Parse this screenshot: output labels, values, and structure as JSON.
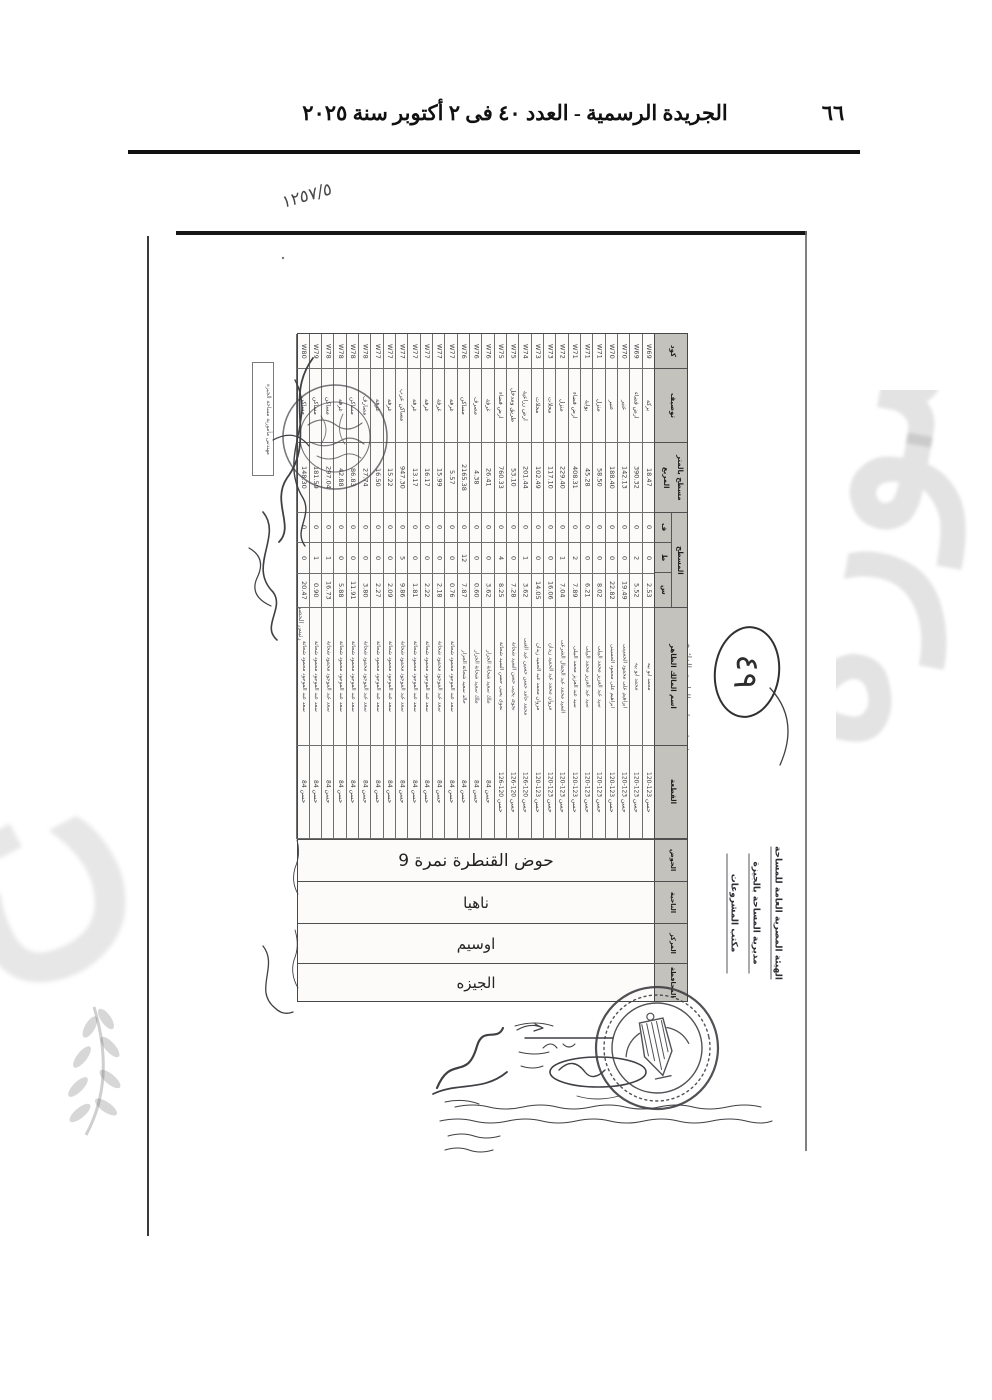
{
  "gazette": {
    "header_title": "الجريدة الرسمية - العدد ٤٠ فى ٢ أكتوبر سنة ٢٠٢٥",
    "page_number": "٦٦"
  },
  "annotations": {
    "file_mark": "١٢٥٧/٥",
    "circled_number": "٤٩",
    "side_title": "حصر ملاك ظاهرين لمشروع انشاء وتطوير الطريق الدائرى"
  },
  "agency": {
    "lines": [
      "الهيئة المصرية العامة للمساحة",
      "مديرية المساحة بالجيزة",
      "مكتب المشروعات"
    ]
  },
  "stamps": {
    "box_label": "مهندس مأمورية مساحة الجيزة",
    "review_label": "رئيس الحصر"
  },
  "watermark": {
    "fragment": "صورة"
  },
  "table": {
    "headers": {
      "code": "كود",
      "desc": "توصيف",
      "area": "مسطح بالمتر المربع",
      "surface": "المسطح",
      "surface_subs": [
        "ف",
        "ط",
        "س"
      ],
      "owner": "اسم المالك الظاهر",
      "parcel": "القطعة",
      "basin": "الحوض",
      "village": "الناحية",
      "district": "المركز",
      "governorate": "المحافظة"
    },
    "basin_value": "حوض القنطرة نمرة 9",
    "village_value": "ناهيا",
    "district_value": "اوسيم",
    "governorate_value": "الجيزه",
    "rows": [
      {
        "code": "W69",
        "desc": "بركة",
        "area": "18.47",
        "f": "0",
        "t": "0",
        "s": "2.53",
        "owner": "محمد ابو بيه",
        "parcel": "حسن 123-120"
      },
      {
        "code": "W69",
        "desc": "ارض فضاء",
        "area": "390.32",
        "f": "0",
        "t": "2",
        "s": "5.52",
        "owner": "محمد ابو بيه",
        "parcel": "حسن 123-120"
      },
      {
        "code": "W70",
        "desc": "عنبر",
        "area": "142.13",
        "f": "0",
        "t": "0",
        "s": "19.49",
        "owner": "ابراهيم على محمود الحسينى",
        "parcel": "حسن 123-120"
      },
      {
        "code": "W70",
        "desc": "عنبر",
        "area": "188.40",
        "f": "0",
        "t": "0",
        "s": "22.82",
        "owner": "ابراهيم على محمود الحسينى",
        "parcel": "حسن 123-120"
      },
      {
        "code": "W71",
        "desc": "منزل",
        "area": "58.50",
        "f": "0",
        "t": "0",
        "s": "8.02",
        "owner": "سيد عبد العزيز محمد البيلى",
        "parcel": "حسن 123-120"
      },
      {
        "code": "W71",
        "desc": "بوابة",
        "area": "45.28",
        "f": "0",
        "t": "0",
        "s": "6.21",
        "owner": "سيد عبد العزيز محمد البيلى",
        "parcel": "حسن 123-120"
      },
      {
        "code": "W71",
        "desc": "ارض فضاء",
        "area": "408.31",
        "f": "0",
        "t": "2",
        "s": "7.89",
        "owner": "سيد عبد العزيز محمد البيلى",
        "parcel": "حسن 123-120"
      },
      {
        "code": "W72",
        "desc": "منزل",
        "area": "229.40",
        "f": "0",
        "t": "1",
        "s": "7.04",
        "owner": "السيد محمد عبد الجمال الشرعى",
        "parcel": "حسن 123-120"
      },
      {
        "code": "W73",
        "desc": "محلات",
        "area": "117.10",
        "f": "0",
        "t": "0",
        "s": "16.06",
        "owner": "مروان محمد عبد الحميد زيدان",
        "parcel": "حسن 123-120"
      },
      {
        "code": "W73",
        "desc": "محلات",
        "area": "102.49",
        "f": "0",
        "t": "0",
        "s": "14.05",
        "owner": "مروان محمد عبد الحميد زيدان",
        "parcel": "حسن 123-120"
      },
      {
        "code": "W74",
        "desc": "ارض زراعية",
        "area": "201.44",
        "f": "0",
        "t": "1",
        "s": "3.62",
        "owner": "محمد حامد حسن حسين عبد الغنى",
        "parcel": "حسن 120-126"
      },
      {
        "code": "W75",
        "desc": "طريق ومدخل",
        "area": "53.10",
        "f": "0",
        "t": "0",
        "s": "7.28",
        "owner": "نجوى يحيى حسن السيد شحاتة",
        "parcel": "حسن 120-126"
      },
      {
        "code": "W75",
        "desc": "ارض فضاء",
        "area": "760.33",
        "f": "0",
        "t": "4",
        "s": "8.25",
        "owner": "نجوى يحيى حسن السيد شحاتة",
        "parcel": "حسن 120-126"
      },
      {
        "code": "W76",
        "desc": "غرفة",
        "area": "26.41",
        "f": "0",
        "t": "0",
        "s": "3.62",
        "owner": "ملك سعيد شحاتة الجزار",
        "parcel": "حسن 84"
      },
      {
        "code": "W76",
        "desc": "مصرف",
        "area": "4.38",
        "f": "0",
        "t": "0",
        "s": "0.60",
        "owner": "ملك سعيد شحاتة الجزار",
        "parcel": "حسن 84"
      },
      {
        "code": "W76",
        "desc": "مساكن",
        "area": "2165.38",
        "f": "0",
        "t": "12",
        "s": "7.87",
        "owner": "خالد سعيد شحاتة الجزار",
        "parcel": "حسن 84"
      },
      {
        "code": "W77",
        "desc": "غرفة",
        "area": "5.57",
        "f": "0",
        "t": "0",
        "s": "0.76",
        "owner": "سعد عبد الموجود محمود شحاتة",
        "parcel": "حسن 84"
      },
      {
        "code": "W77",
        "desc": "غرفة",
        "area": "15.99",
        "f": "0",
        "t": "0",
        "s": "2.18",
        "owner": "سعد عبد الموجود محمود شحاتة",
        "parcel": "حسن 84"
      },
      {
        "code": "W77",
        "desc": "غرفة",
        "area": "16.17",
        "f": "0",
        "t": "0",
        "s": "2.22",
        "owner": "سعد عبد الموجود محمود شحاتة",
        "parcel": "حسن 84"
      },
      {
        "code": "W77",
        "desc": "غرفة",
        "area": "13.17",
        "f": "0",
        "t": "0",
        "s": "1.81",
        "owner": "سعد عبد الموجود محمود شحاتة",
        "parcel": "حسن 84"
      },
      {
        "code": "W77",
        "desc": "مساكن عرب",
        "area": "947.30",
        "f": "0",
        "t": "5",
        "s": "9.86",
        "owner": "سعد عبد الموجود محمود شحاتة",
        "parcel": "حسن 84"
      },
      {
        "code": "W77",
        "desc": "غرفة",
        "area": "15.22",
        "f": "0",
        "t": "0",
        "s": "2.09",
        "owner": "سعد عبد الموجود محمود شحاتة",
        "parcel": "حسن 84"
      },
      {
        "code": "W77",
        "desc": "غرفة",
        "area": "16.50",
        "f": "0",
        "t": "0",
        "s": "2.27",
        "owner": "سعد عبد الموجود محمود شحاتة",
        "parcel": "حسن 84"
      },
      {
        "code": "W78",
        "desc": "مصارف",
        "area": "27.74",
        "f": "0",
        "t": "0",
        "s": "3.80",
        "owner": "سعد عبد الموجود محمود شحاتة",
        "parcel": "حسن 84"
      },
      {
        "code": "W78",
        "desc": "مساكن",
        "area": "86.83",
        "f": "0",
        "t": "0",
        "s": "11.91",
        "owner": "سعد عبد الموجود محمود شحاتة",
        "parcel": "حسن 84"
      },
      {
        "code": "W78",
        "desc": "غرفة",
        "area": "42.88",
        "f": "0",
        "t": "0",
        "s": "5.88",
        "owner": "سعد عبد الموجود محمود شحاتة",
        "parcel": "حسن 84"
      },
      {
        "code": "W78",
        "desc": "مساكن",
        "area": "297.04",
        "f": "0",
        "t": "1",
        "s": "16.73",
        "owner": "سعد عبد الموجود محمود شحاتة",
        "parcel": "حسن 84"
      },
      {
        "code": "W79",
        "desc": "مساكن",
        "area": "181.59",
        "f": "0",
        "t": "1",
        "s": "0.90",
        "owner": "سعد عبد الموجود محمود شحاتة",
        "parcel": "حسن 84"
      },
      {
        "code": "W80",
        "desc": "مساكن",
        "area": "148.30",
        "f": "0",
        "t": "0",
        "s": "20.47",
        "owner": "سعد عبد الموجود محمود شحاتة",
        "parcel": "حسن 84"
      }
    ]
  }
}
